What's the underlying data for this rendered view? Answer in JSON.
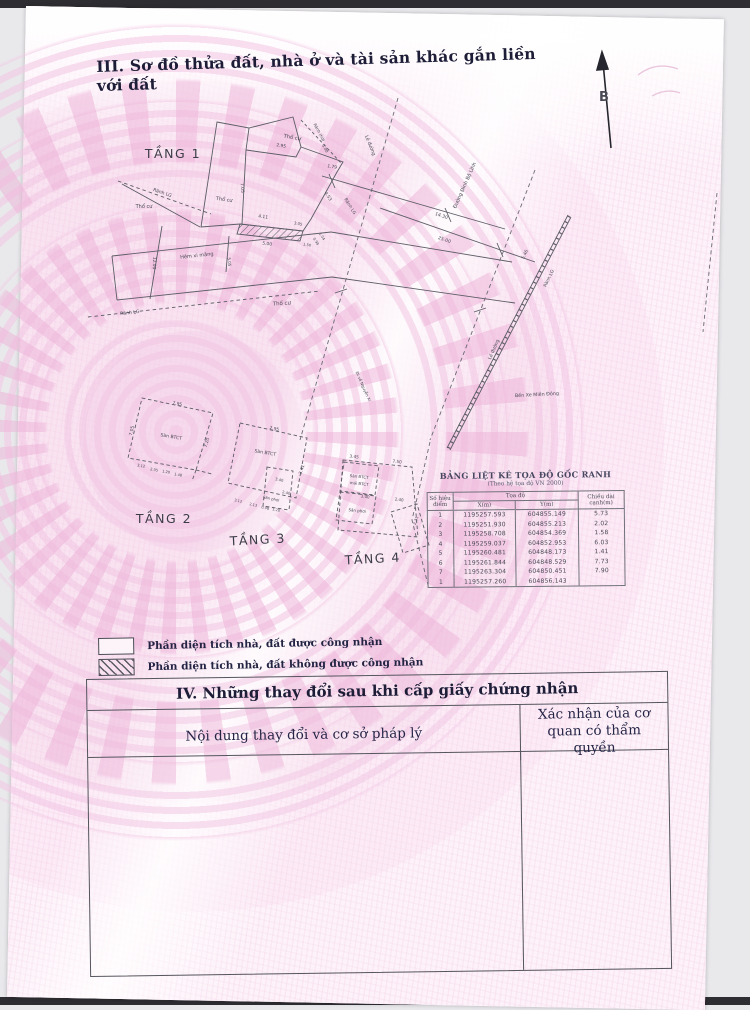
{
  "page": {
    "title": "III. Sơ đồ thửa đất, nhà ở và tài sản khác gắn liền với đất"
  },
  "compass": {
    "north": "B"
  },
  "plan": {
    "floor_labels": {
      "f1": "TẦNG 1",
      "f2": "TẦNG 2",
      "f3": "TẦNG 3",
      "f4": "TẦNG 4"
    },
    "labels": {
      "tho_cu": "Thổ cư",
      "ranh_lg": "Rãnh LG",
      "ranh_ho": "Rãnh (hở)",
      "hem_xi_mang": "Hẻm xi măng",
      "le_duong": "Lề đường",
      "duong_dinh_bo_linh": "Đường Đinh Bộ Lĩnh",
      "di_ve_nguyen_xi": "Đi về Nguyễn Xí",
      "ben_xe_mien_dong": "Bến Xe Miền Đông",
      "san_btct": "Sàn BTCT",
      "mai_btct": "mái BTCT",
      "san_phoi": "Sân phơi"
    },
    "dims": {
      "d295": "2.95",
      "d179": "1.79",
      "d500": "5.00",
      "d453": "4.53",
      "d411": "4.11",
      "d305": "3.05",
      "d150": "1.50",
      "d098": "0.98",
      "d104": "1.04",
      "d705": "7.05",
      "d1200": "12.00",
      "d505": "5.05",
      "d1430": "14.30",
      "d2500": "25.00",
      "d546": "5.46",
      "d795": "7.95",
      "d720": "7.20",
      "d312": "3.12",
      "d205": "2.05",
      "d120": "1.20",
      "d148": "1.48",
      "d213": "2.13",
      "d341": "3.41",
      "d340": "3.40",
      "d240": "2.40",
      "d345": "3.45",
      "d750": "7.50",
      "d231": "2.31"
    }
  },
  "coord_table": {
    "title": "BẢNG LIỆT KÊ TỌA ĐỘ GỐC RANH",
    "subtitle": "(Theo hệ tọa độ VN 2000)",
    "col_point": "Số hiệu điểm",
    "col_coords": "Tọa độ",
    "col_x": "X(m)",
    "col_y": "Y(m)",
    "col_len": "Chiều dài cạnh(m)",
    "rows": [
      {
        "p": "1",
        "x": "1195257.593",
        "y": "604855.149",
        "d": "5.73"
      },
      {
        "p": "2",
        "x": "1195251.930",
        "y": "604855.213",
        "d": "2.02"
      },
      {
        "p": "3",
        "x": "1195258.708",
        "y": "604854.369",
        "d": "1.58"
      },
      {
        "p": "4",
        "x": "1195259.037",
        "y": "604852.953",
        "d": "6.03"
      },
      {
        "p": "5",
        "x": "1195260.481",
        "y": "604848.173",
        "d": "1.41"
      },
      {
        "p": "6",
        "x": "1195261.844",
        "y": "604848.529",
        "d": "7.73"
      },
      {
        "p": "7",
        "x": "1195263.304",
        "y": "604850.451",
        "d": "7.90"
      },
      {
        "p": "1",
        "x": "1195257.260",
        "y": "604856.143",
        "d": ""
      }
    ]
  },
  "legend": {
    "recognized": "Phần diện tích nhà, đất được công nhận",
    "not_recognized": "Phần diện tích nhà, đất không được công nhận"
  },
  "section4": {
    "title": "IV. Những thay đổi sau khi cấp giấy chứng nhận",
    "col_content": "Nội dung thay đổi và cơ sở pháp lý",
    "col_confirm": "Xác nhận của cơ quan có thẩm quyền"
  }
}
